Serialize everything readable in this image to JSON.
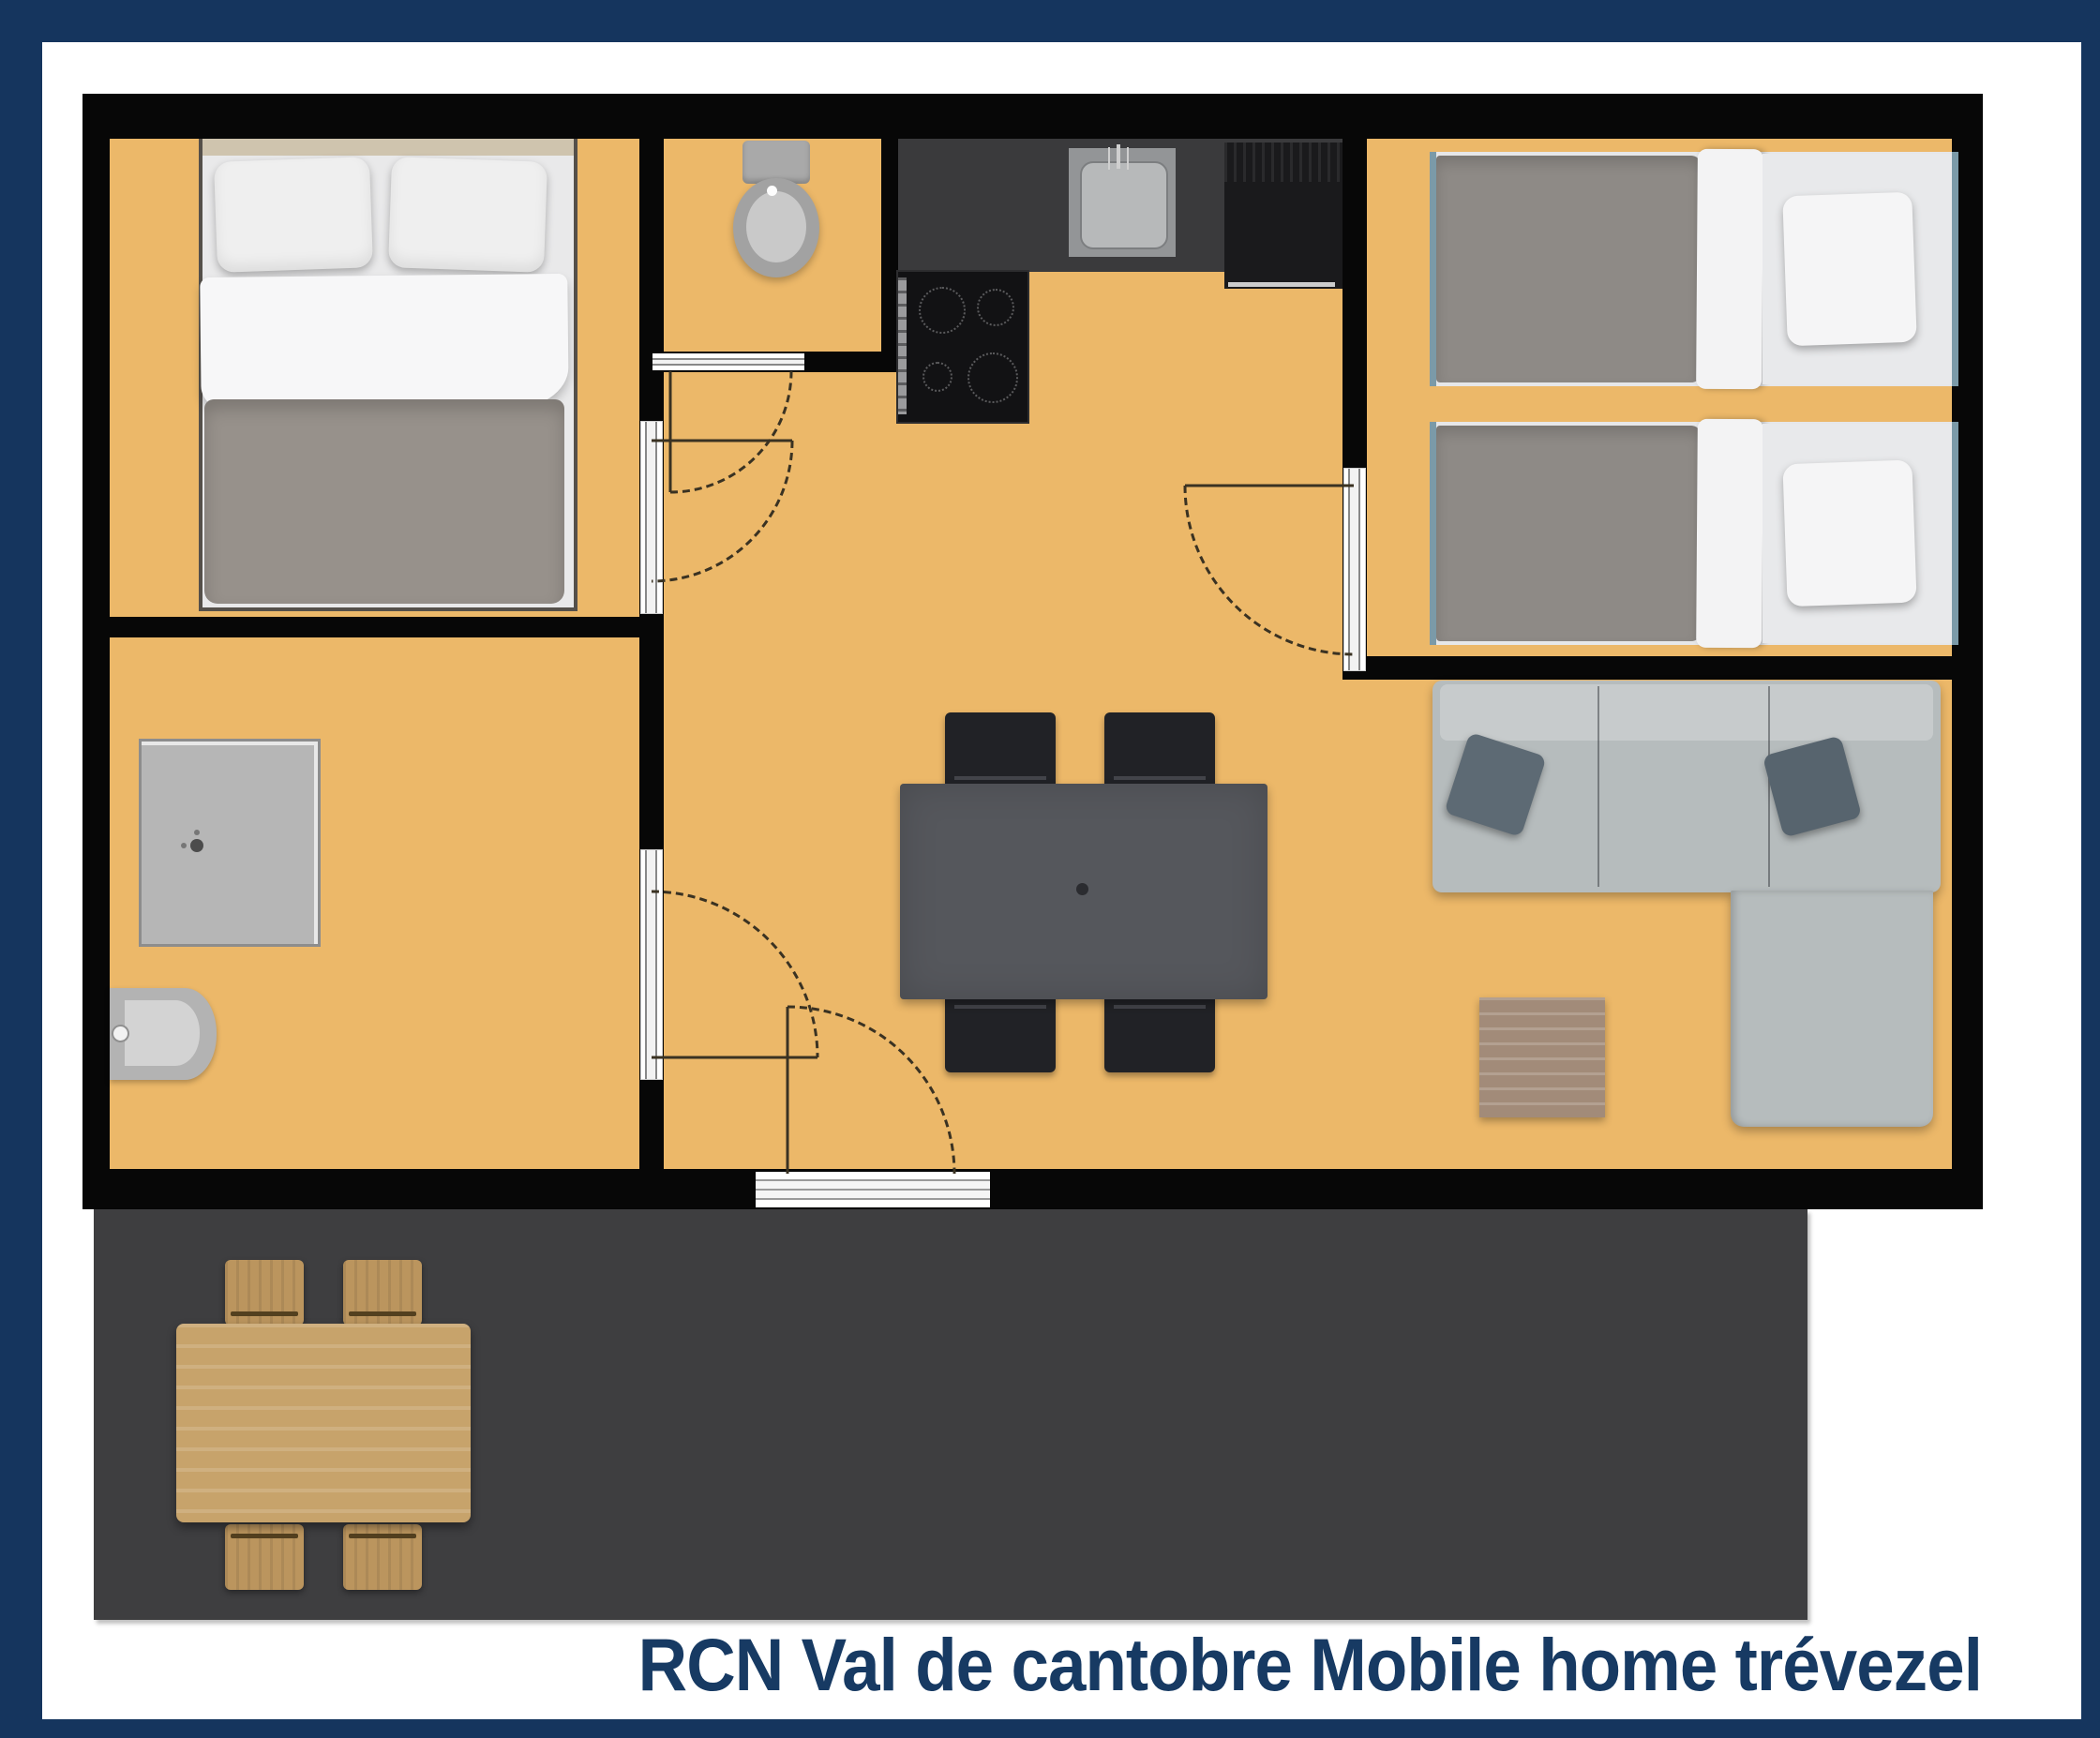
{
  "caption": {
    "text": "RCN Val de cantobre Mobile home trévezel"
  },
  "colors": {
    "border_navy": "#15355e",
    "caption_navy": "#173a63",
    "wall_black": "#070707",
    "floor_orange": "#ecb869",
    "terrace_gray": "#3e3e40",
    "bg_white": "#ffffff",
    "counter_gray": "#3a3a3c",
    "sofa_gray": "#b6bcbd",
    "wood_tan": "#c7a36b",
    "bedframe_teal": "#7b9aa8"
  }
}
